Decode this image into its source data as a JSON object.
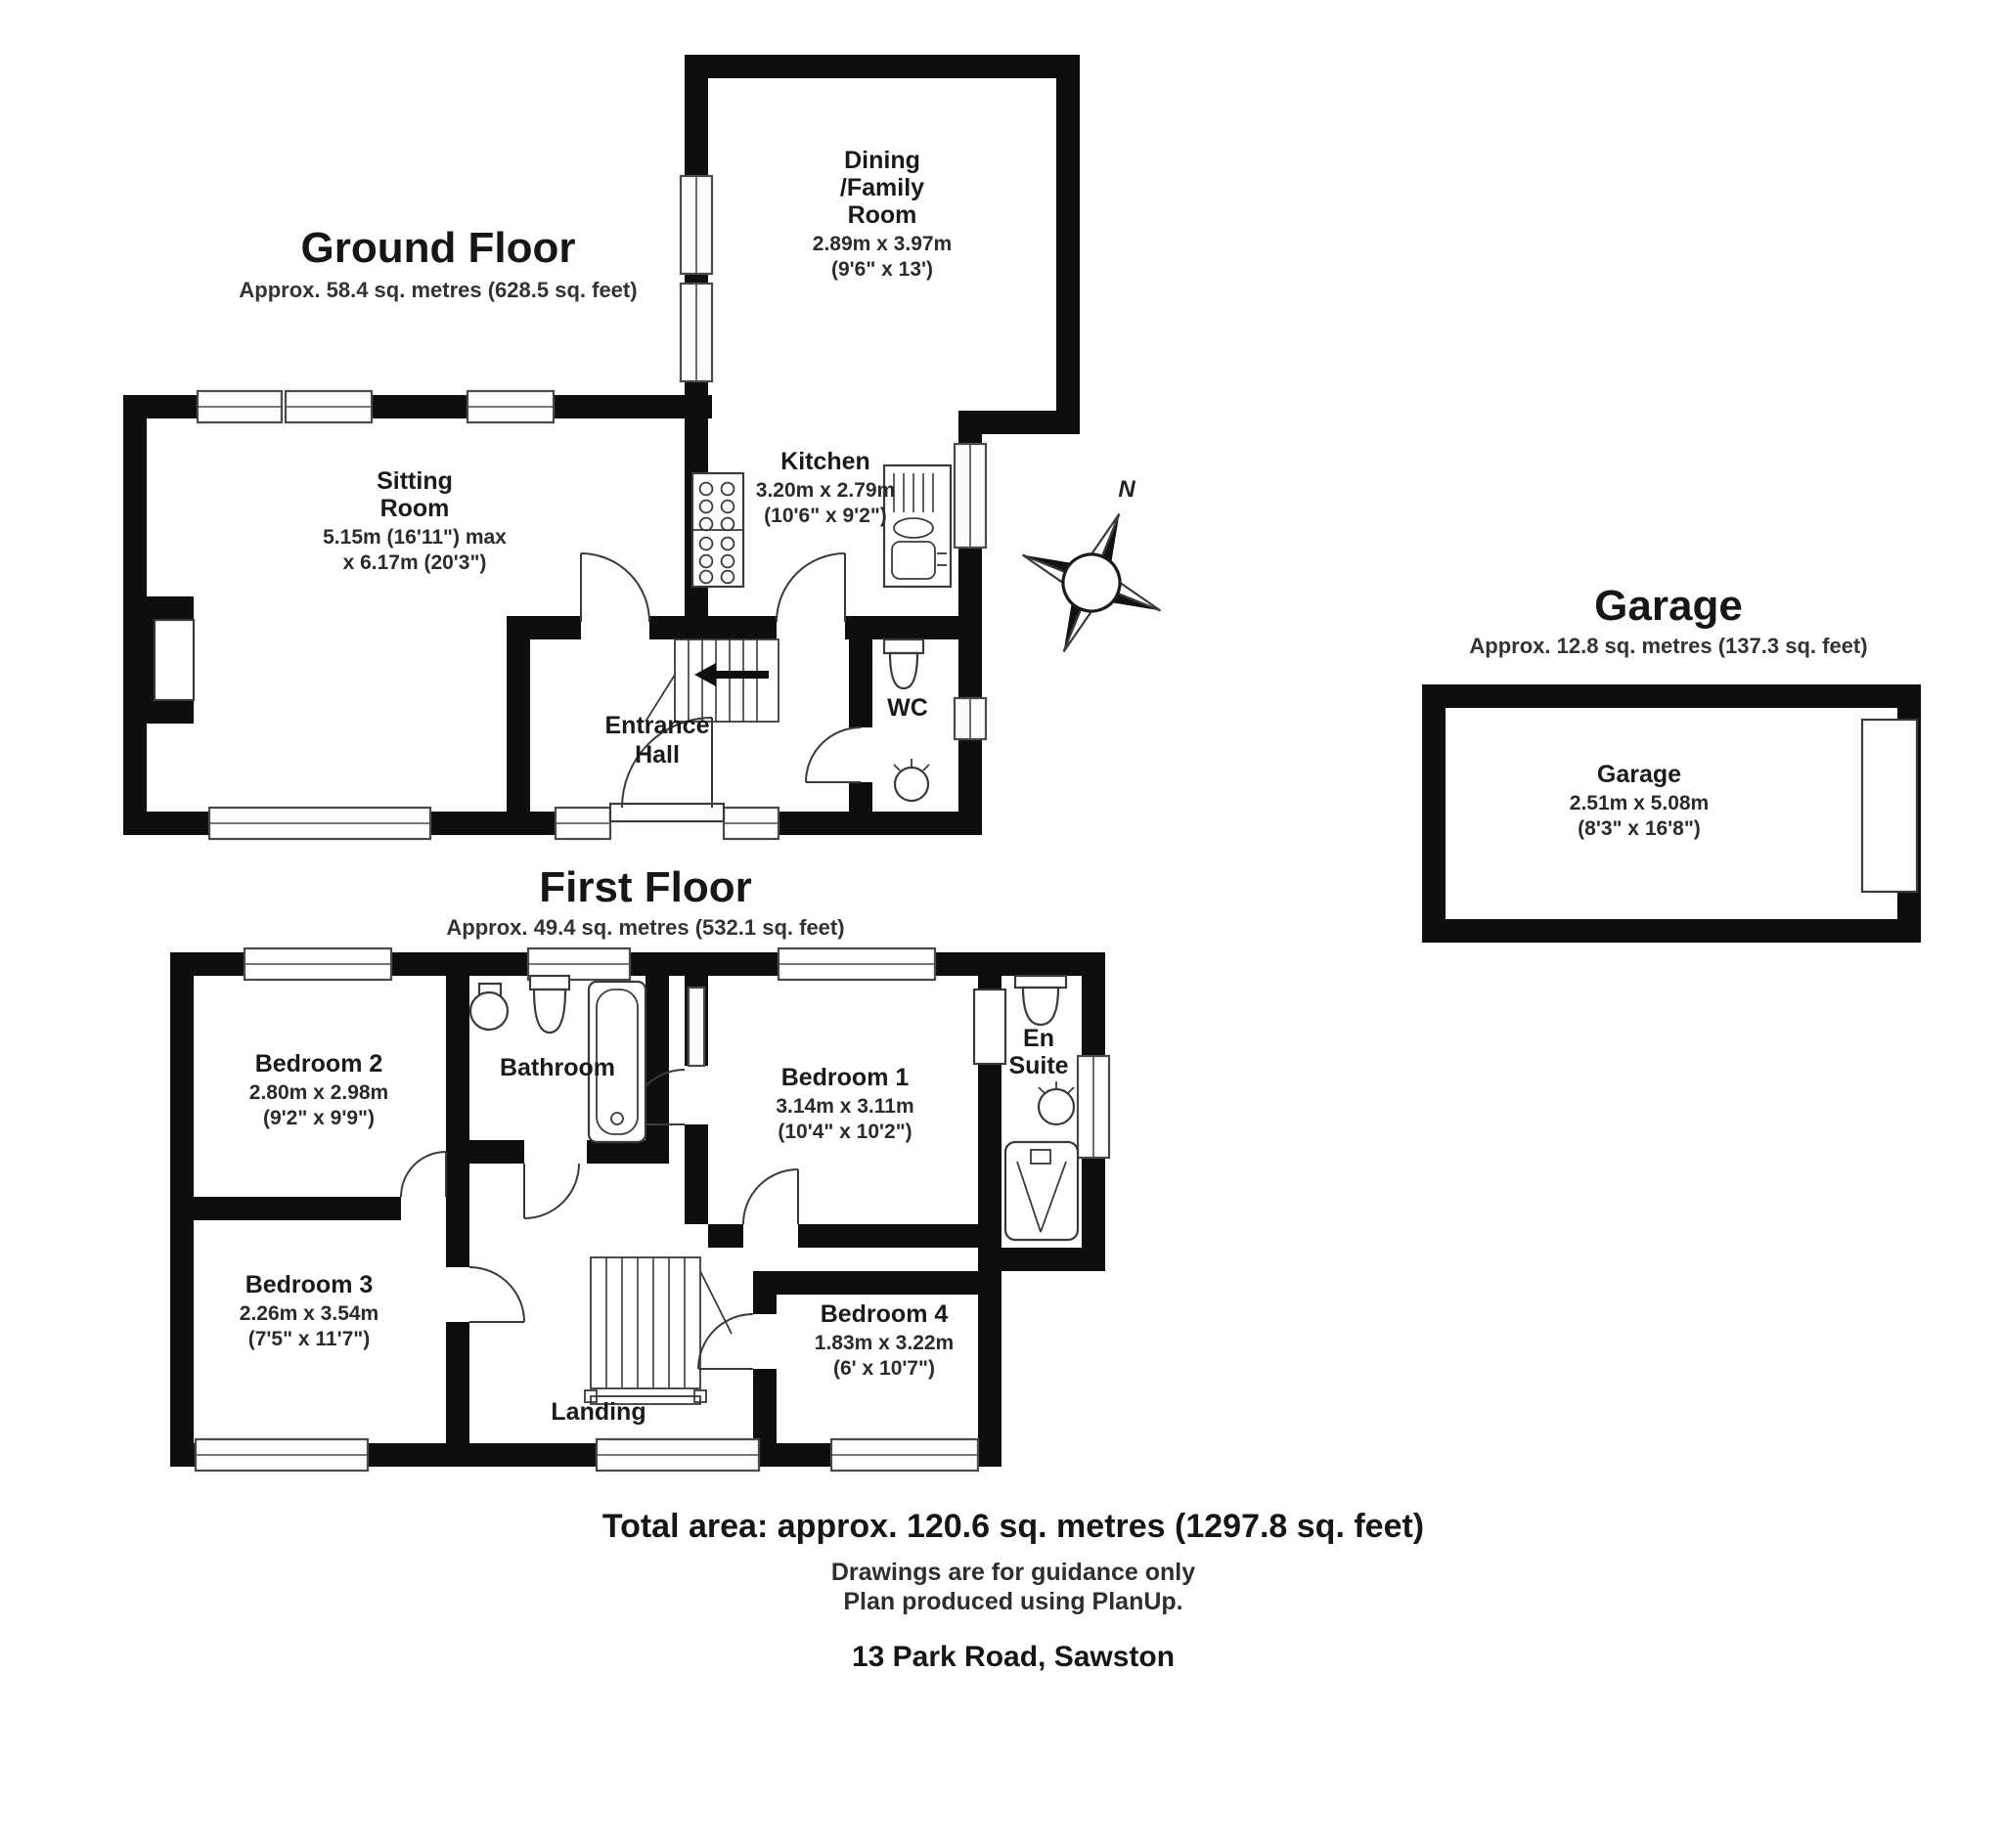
{
  "ground_floor": {
    "title": "Ground Floor",
    "subtitle": "Approx.  58.4 sq. metres (628.5 sq. feet)",
    "rooms": {
      "dining": {
        "line1": "Dining",
        "line2": "/Family",
        "line3": "Room",
        "dims1": "2.89m x 3.97m",
        "dims2": "(9'6\" x 13')"
      },
      "sitting": {
        "line1": "Sitting",
        "line2": "Room",
        "dims1": "5.15m (16'11\") max",
        "dims2": "x 6.17m (20'3\")"
      },
      "kitchen": {
        "name": "Kitchen",
        "dims1": "3.20m x 2.79m",
        "dims2": "(10'6\" x 9'2\")"
      },
      "hall": {
        "line1": "Entrance",
        "line2": "Hall"
      },
      "wc": {
        "name": "WC"
      }
    }
  },
  "first_floor": {
    "title": "First Floor",
    "subtitle": "Approx.  49.4 sq. metres (532.1 sq. feet)",
    "rooms": {
      "bedroom2": {
        "name": "Bedroom 2",
        "dims1": "2.80m x 2.98m",
        "dims2": "(9'2\" x 9'9\")"
      },
      "bathroom": {
        "name": "Bathroom"
      },
      "bedroom1": {
        "name": "Bedroom 1",
        "dims1": "3.14m x 3.11m",
        "dims2": "(10'4\" x 10'2\")"
      },
      "ensuite": {
        "line1": "En",
        "line2": "Suite"
      },
      "bedroom3": {
        "name": "Bedroom 3",
        "dims1": "2.26m x 3.54m",
        "dims2": "(7'5\" x 11'7\")"
      },
      "landing": {
        "name": "Landing"
      },
      "bedroom4": {
        "name": "Bedroom 4",
        "dims1": "1.83m x 3.22m",
        "dims2": "(6' x 10'7\")"
      }
    }
  },
  "garage": {
    "title": "Garage",
    "subtitle": "Approx.  12.8 sq. metres (137.3 sq. feet)",
    "room": {
      "name": "Garage",
      "dims1": "2.51m x 5.08m",
      "dims2": "(8'3\" x 16'8\")"
    }
  },
  "compass": {
    "north_label": "N"
  },
  "footer": {
    "total_area": "Total area: approx. 120.6 sq. metres (1297.8 sq. feet)",
    "disclaimer1": "Drawings are for guidance only",
    "disclaimer2": "Plan produced using PlanUp.",
    "address": "13 Park Road, Sawston"
  }
}
